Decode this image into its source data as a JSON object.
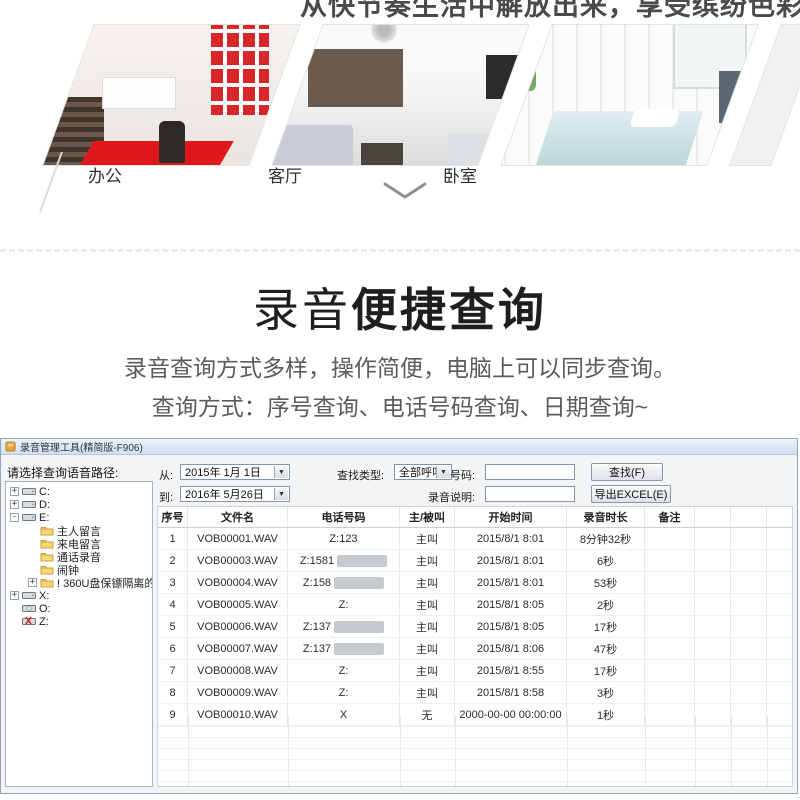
{
  "hero": {
    "tagline": "从快节奏生活中解放出来，享受缤纷色彩绚丽生活",
    "images": [
      {
        "label": "办公"
      },
      {
        "label": "客厅"
      },
      {
        "label": "卧室"
      }
    ]
  },
  "section": {
    "title_light": "录音",
    "title_bold": "便捷查询",
    "subtitle_line1": "录音查询方式多样，操作简便，电脑上可以同步查询。",
    "subtitle_line2": "查询方式：序号查询、电话号码查询、日期查询~"
  },
  "app": {
    "title": "录音管理工具(精简版-F906)",
    "tree": {
      "label": "请选择查询语音路径:",
      "items": [
        {
          "text": "C:",
          "icon": "drive",
          "expander": "+",
          "level": 0
        },
        {
          "text": "D:",
          "icon": "drive",
          "expander": "+",
          "level": 0
        },
        {
          "text": "E:",
          "icon": "drive",
          "expander": "-",
          "level": 0
        },
        {
          "text": "主人留言",
          "icon": "folder",
          "expander": "",
          "level": 1
        },
        {
          "text": "来电留言",
          "icon": "folder",
          "expander": "",
          "level": 1
        },
        {
          "text": "通话录音",
          "icon": "folder",
          "expander": "",
          "level": 1
        },
        {
          "text": "闹钟",
          "icon": "folder",
          "expander": "",
          "level": 1
        },
        {
          "text": "! 360U盘保镖隔离的文件",
          "icon": "folder",
          "expander": "+",
          "level": 1
        },
        {
          "text": "X:",
          "icon": "drive",
          "expander": "+",
          "level": 0
        },
        {
          "text": "O:",
          "icon": "disc",
          "expander": "",
          "level": 0
        },
        {
          "text": "Z:",
          "icon": "drive-x",
          "expander": "",
          "level": 0
        }
      ]
    },
    "filters": {
      "from_label": "从:",
      "from_value": "2015年 1月 1日",
      "to_label": "到:",
      "to_value": "2016年 5月26日",
      "type_label": "查找类型:",
      "type_value": "全部呼叫",
      "number_label": "号码:",
      "number_value": "",
      "note_label": "录音说明:",
      "note_value": "",
      "search_button": "查找(F)",
      "export_button": "导出EXCEL(E)"
    },
    "table": {
      "headers": [
        "序号",
        "文件名",
        "电话号码",
        "主/被叫",
        "开始时间",
        "录音时长",
        "备注"
      ],
      "rows": [
        {
          "no": "1",
          "file": "VOB00001.WAV",
          "phone": "Z:123",
          "redacted": false,
          "caller": "主叫",
          "start": "2015/8/1 8:01",
          "duration": "8分钟32秒",
          "note": ""
        },
        {
          "no": "2",
          "file": "VOB00003.WAV",
          "phone": "Z:1581",
          "redacted": true,
          "caller": "主叫",
          "start": "2015/8/1 8:01",
          "duration": "6秒",
          "note": ""
        },
        {
          "no": "3",
          "file": "VOB00004.WAV",
          "phone": "Z:158",
          "redacted": true,
          "caller": "主叫",
          "start": "2015/8/1 8:01",
          "duration": "53秒",
          "note": ""
        },
        {
          "no": "4",
          "file": "VOB00005.WAV",
          "phone": "Z:",
          "redacted": false,
          "caller": "主叫",
          "start": "2015/8/1 8:05",
          "duration": "2秒",
          "note": ""
        },
        {
          "no": "5",
          "file": "VOB00006.WAV",
          "phone": "Z:137",
          "redacted": true,
          "caller": "主叫",
          "start": "2015/8/1 8:05",
          "duration": "17秒",
          "note": ""
        },
        {
          "no": "6",
          "file": "VOB00007.WAV",
          "phone": "Z:137",
          "redacted": true,
          "caller": "主叫",
          "start": "2015/8/1 8:06",
          "duration": "47秒",
          "note": ""
        },
        {
          "no": "7",
          "file": "VOB00008.WAV",
          "phone": "Z:",
          "redacted": false,
          "caller": "主叫",
          "start": "2015/8/1 8:55",
          "duration": "17秒",
          "note": ""
        },
        {
          "no": "8",
          "file": "VOB00009.WAV",
          "phone": "Z:",
          "redacted": false,
          "caller": "主叫",
          "start": "2015/8/1 8:58",
          "duration": "3秒",
          "note": ""
        },
        {
          "no": "9",
          "file": "VOB00010.WAV",
          "phone": "X",
          "redacted": false,
          "caller": "无",
          "start": "2000-00-00 00:00:00",
          "duration": "1秒",
          "note": ""
        }
      ]
    }
  },
  "colors": {
    "accent_red": "#d8262a",
    "titlebar_blue": "#dce9f6",
    "redaction_gray": "#c7cacc"
  }
}
